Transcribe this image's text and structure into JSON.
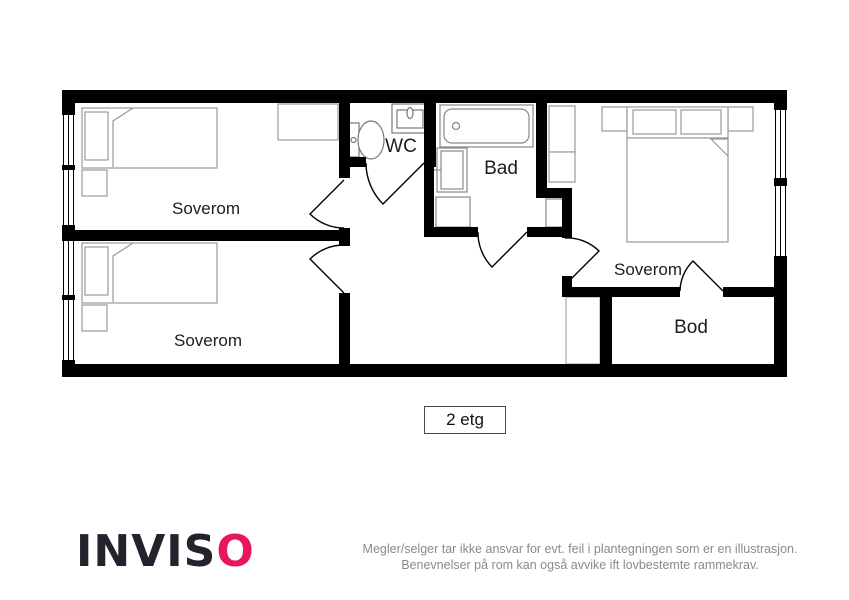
{
  "plan": {
    "floor_label": "2 etg",
    "rooms": [
      {
        "id": "soverom-top-left",
        "label": "Soverom"
      },
      {
        "id": "soverom-bottom-left",
        "label": "Soverom"
      },
      {
        "id": "wc",
        "label": "WC"
      },
      {
        "id": "bad",
        "label": "Bad"
      },
      {
        "id": "soverom-right",
        "label": "Soverom"
      },
      {
        "id": "bod",
        "label": "Bod"
      }
    ],
    "icons": {
      "bed-icon": "rectangle with pillow and folded duvet corner",
      "nightstand-icon": "small rectangle beside bed",
      "wardrobe-icon": "rectangle against wall",
      "toilet-icon": "tank rectangle with oval bowl",
      "sink-icon": "rectangle with small oval basin",
      "bathtub-icon": "rounded inner rectangle with drain circle",
      "shower-icon": "rectangle with tap handle",
      "cabinet-icon": "small rectangle",
      "window-icon": "triple thin lines in wall gap",
      "door-icon": "leaf line with quarter-circle swing arc"
    }
  },
  "footer": {
    "logo_text": "INVIS",
    "logo_o": "O",
    "disclaimer_line1": "Megler/selger tar ikke ansvar for evt. feil i plantegningen som er en illustrasjon.",
    "disclaimer_line2": "Benevnelser på rom kan også avvike ift lovbestemte rammekrav."
  },
  "colors": {
    "walls": "#000000",
    "furniture_outline": "#999999",
    "label_text": "#1c1c1c",
    "logo_dark": "#23232d",
    "logo_accent": "#e8175d",
    "disclaimer_text": "#8a8a8a"
  }
}
